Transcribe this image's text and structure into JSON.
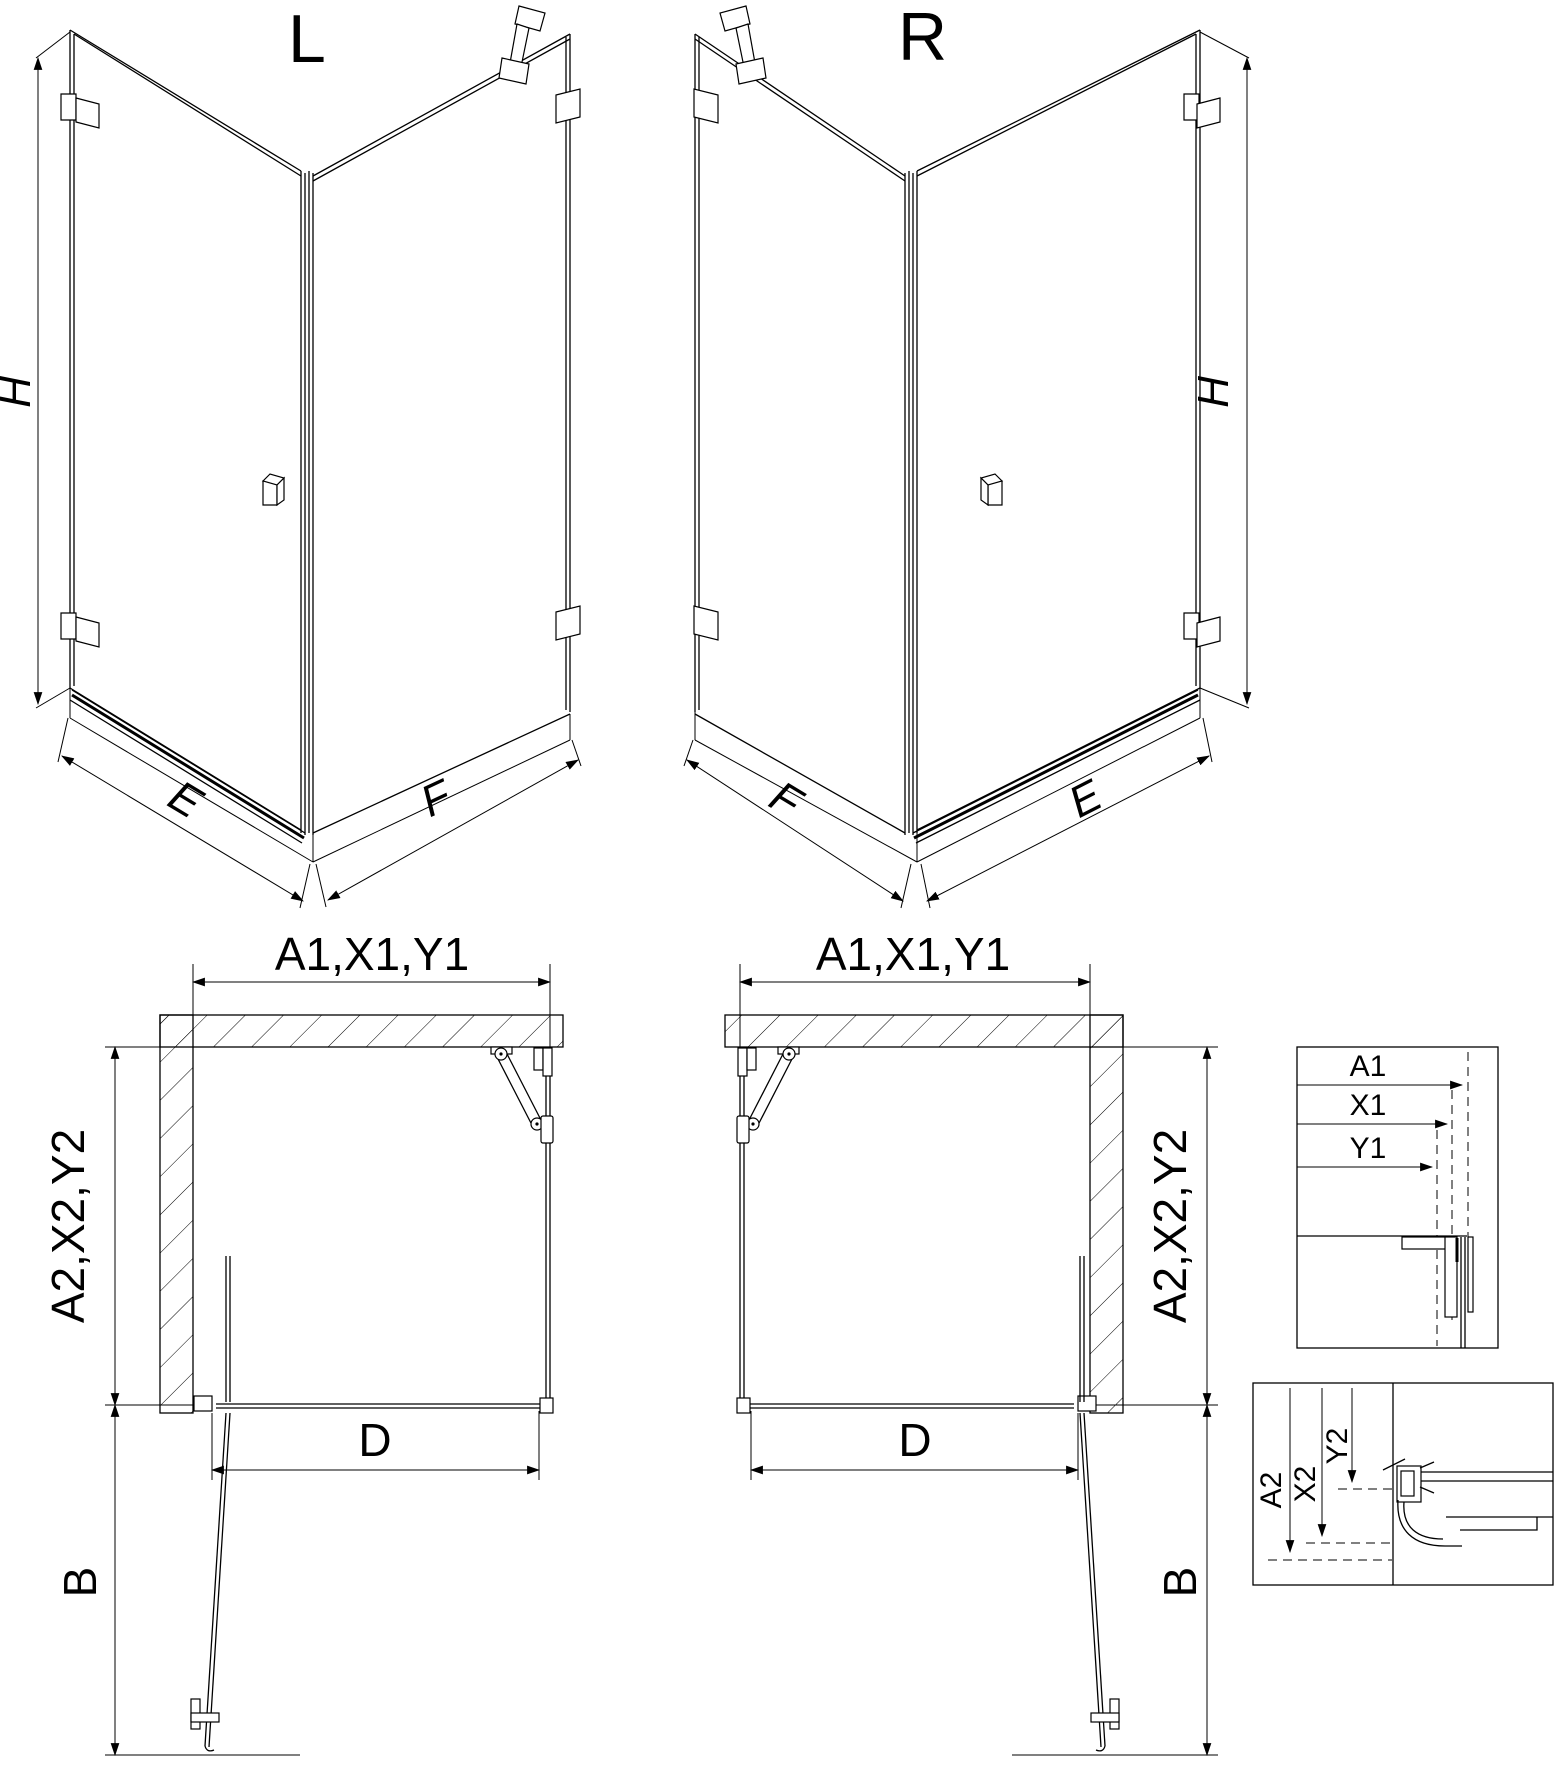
{
  "views": {
    "iso_left": {
      "label": "L",
      "height_dim": "H",
      "door_width_dim": "E",
      "side_width_dim": "F"
    },
    "iso_right": {
      "label": "R",
      "height_dim": "H",
      "door_width_dim": "E",
      "side_width_dim": "F"
    },
    "plan_left": {
      "top_dim": "A1,X1,Y1",
      "side_dim": "A2,X2,Y2",
      "opening_dim": "D",
      "door_projection_dim": "B"
    },
    "plan_right": {
      "top_dim": "A1,X1,Y1",
      "side_dim": "A2,X2,Y2",
      "opening_dim": "D",
      "door_projection_dim": "B"
    },
    "detail_width": {
      "dims": [
        "A1",
        "X1",
        "Y1"
      ]
    },
    "detail_depth": {
      "dims": [
        "A2",
        "X2",
        "Y2"
      ]
    }
  },
  "colors": {
    "line": "#000000",
    "background": "#ffffff"
  }
}
